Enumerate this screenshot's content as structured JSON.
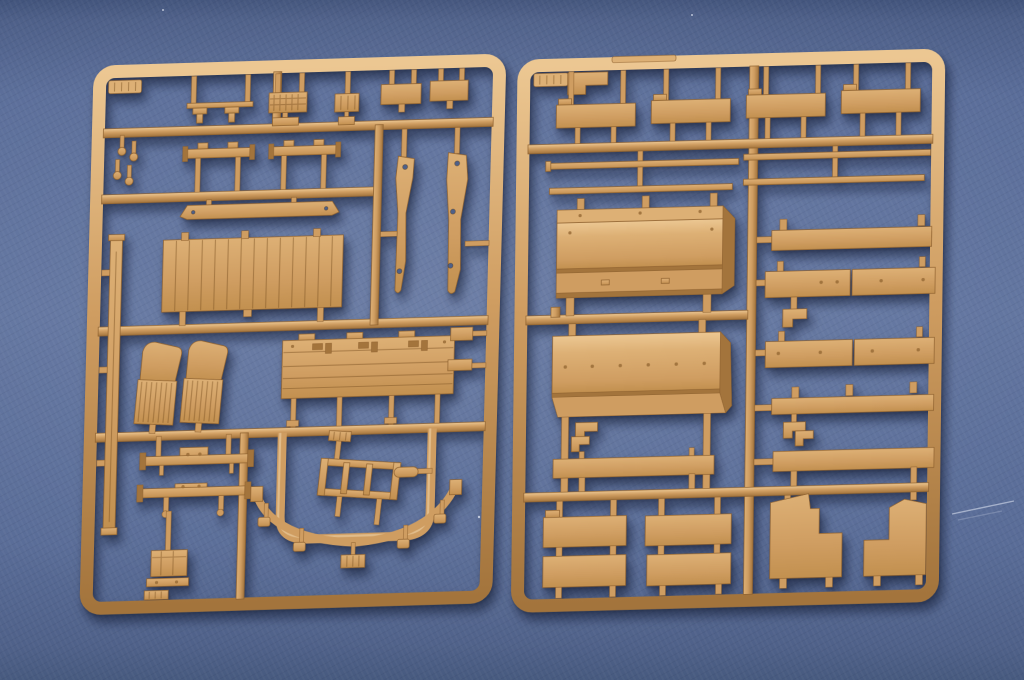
{
  "scene": {
    "description": "Overhead photograph of two tan injection-molded plastic model-kit sprues (part frames) lying side by side on a blue fabric-textured surface",
    "lighting": "soft light from upper left, sprues cast soft shadows down-right",
    "marking_tabs": "each sprue has a small embossed marking tab in its top-left corner; lettering too small to read"
  },
  "colors": {
    "background_top": "#42547c",
    "background_mid": "#5a6d99",
    "background_low": "#4f6189",
    "plastic_highlight": "#ecc792",
    "plastic_light": "#ddb075",
    "plastic_base": "#cf9d61",
    "plastic_mid": "#c2904f",
    "plastic_dark": "#a3743c",
    "plastic_edge": "#8f6230",
    "hole_blue": "#4e6089",
    "shadow": "rgba(18,26,50,0.5)"
  },
  "sprues": {
    "left": {
      "position": "left half of photo, slightly tilted",
      "parts": [
        "embossed marking tab (illegible)",
        "textured tread/grille plate",
        "ribbed block",
        "two small rectangular plates",
        "two clamp brackets on mini rail",
        "four mushroom pegs near left frame",
        "two flanged bumper beams",
        "drilled bumper strip",
        "large planked cargo-bed floor panel",
        "two drilled chassis blade rails",
        "two ribbed fender/step pieces",
        "hinged cargo-bed side panel with latches",
        "long channel beam along left frame",
        "two cross-member bars with center boxes",
        "three-rung ladder",
        "oval pill part",
        "curved stud strip with five hanging bolt heads",
        "ribbed box with bolted bar and small plate",
        "two small wall brackets on right frame"
      ]
    },
    "right": {
      "position": "right half of photo, slightly tilted",
      "parts": [
        "embossed marking tab (illegible)",
        "corner step block",
        "four side boards in top row",
        "four thin tie rods in two rows",
        "two large folded bed panels with bolt-head detail",
        "long top rail plank",
        "two two-piece plank pairs with bolt detail",
        "pegged rail plank",
        "two small L-brackets",
        "two angle tabs above long planks",
        "four rectangular floor boards in two columns",
        "two seat-side profile panels"
      ]
    }
  },
  "background": {
    "surface": "blue fabric mat",
    "details": [
      "light diagonal scratch near right edge",
      "a few tiny dust specks"
    ]
  }
}
